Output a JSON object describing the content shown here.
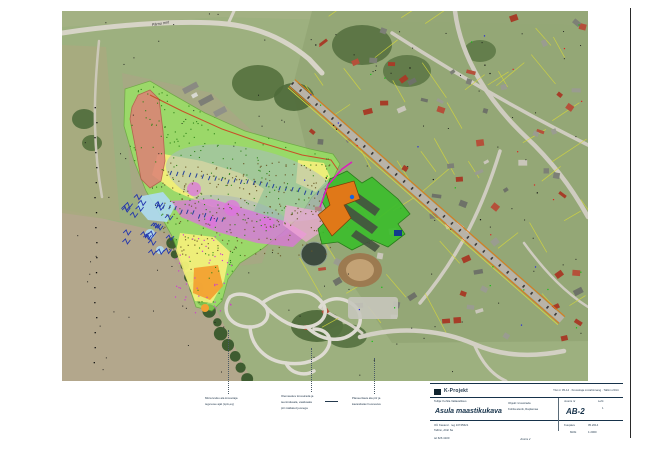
{
  "sheet": {
    "bg": "#ffffff",
    "edge_color": "#2a2a2a"
  },
  "map": {
    "road_label": "Pärnu mnt",
    "base": "#9db07f",
    "fields": [
      {
        "pts": [
          [
            0,
            198
          ],
          [
            112,
            224
          ],
          [
            150,
            290
          ],
          [
            190,
            370
          ],
          [
            0,
            370
          ]
        ],
        "fill": "#b3a78c",
        "op": 1
      },
      {
        "pts": [
          [
            0,
            34
          ],
          [
            44,
            36
          ],
          [
            58,
            210
          ],
          [
            0,
            202
          ]
        ],
        "fill": "#a8ab7f",
        "op": 0.9
      },
      {
        "pts": [
          [
            0,
            0
          ],
          [
            526,
            0
          ],
          [
            526,
            14
          ],
          [
            300,
            10
          ],
          [
            160,
            6
          ],
          [
            0,
            16
          ]
        ],
        "fill": "#a5b284",
        "op": 0.85
      },
      {
        "pts": [
          [
            230,
            78
          ],
          [
            250,
            0
          ],
          [
            526,
            0
          ],
          [
            526,
            330
          ],
          [
            330,
            332
          ],
          [
            268,
            240
          ]
        ],
        "fill": "#94a675",
        "op": 0.9
      },
      {
        "pts": [
          [
            60,
            62
          ],
          [
            150,
            82
          ],
          [
            232,
            160
          ],
          [
            200,
            252
          ],
          [
            120,
            262
          ],
          [
            70,
            182
          ]
        ],
        "fill": "#b0a287",
        "op": 0.5
      }
    ],
    "woods": [
      [
        196,
        72,
        26,
        18,
        "#55713e"
      ],
      [
        232,
        86,
        20,
        14,
        "#4e6a3a"
      ],
      [
        300,
        34,
        30,
        20,
        "#567141"
      ],
      [
        345,
        60,
        24,
        16,
        "#5d7847"
      ],
      [
        255,
        315,
        26,
        16,
        "#4c6838"
      ],
      [
        285,
        325,
        20,
        12,
        "#557140"
      ],
      [
        22,
        108,
        12,
        10,
        "#4f6b3c"
      ],
      [
        30,
        132,
        10,
        8,
        "#55713e"
      ],
      [
        418,
        40,
        16,
        11,
        "#5e7a48"
      ]
    ],
    "roads": [
      {
        "d": "M0,22 C60,13 125,9 165,13 C202,17 228,32 247,48 L260,62",
        "w": 5,
        "c": "#d7d4c7"
      },
      {
        "d": "M166,13 L172,0",
        "w": 3,
        "c": "#d7d4c7"
      },
      {
        "d": "M37,30 C32,80 30,130 40,186",
        "w": 2.5,
        "c": "#ccc8b8"
      },
      {
        "d": "M393,0 C399,48 428,92 464,126 C496,156 515,186 526,206",
        "w": 4.5,
        "c": "#cfccc0"
      },
      {
        "d": "M330,22 C392,62 462,102 526,134",
        "w": 3.5,
        "c": "#cfccc0"
      },
      {
        "d": "M438,140 C422,192 400,242 358,292",
        "w": 3.5,
        "c": "#cfccc0"
      },
      {
        "d": "M462,232 C484,262 504,282 526,296",
        "w": 2.5,
        "c": "#cfccc0"
      },
      {
        "d": "M298,326 C340,314 382,320 412,333 C442,346 472,346 502,340",
        "w": 4.5,
        "c": "#d3d0c4"
      },
      {
        "d": "M412,333 C420,352 430,364 444,370",
        "w": 3,
        "c": "#d3d0c4"
      },
      {
        "d": "M258,296 C270,306 286,310 300,322",
        "w": 3,
        "c": "#d3d0c4"
      }
    ],
    "railway": {
      "x1": 230,
      "y1": 72,
      "x2": 500,
      "y2": 309,
      "body": "#b9b3a8",
      "edge": "#e07818",
      "yellow": "#d8d840"
    },
    "track_paths": [
      "M168,286 C158,300 168,316 188,316 C206,316 211,300 200,292 C190,284 176,280 168,286 Z",
      "M200,292 C220,278 246,276 258,289 C269,300 262,314 245,316 C228,318 211,304 200,292 Z",
      "M245,316 C259,330 279,332 291,322 C303,312 299,297 287,291 C276,285 263,288 258,296",
      "M188,316 C189,335 204,350 224,352 C247,355 263,346 267,334 C270,324 262,318 252,318",
      "M224,352 C228,362 242,366 252,360"
    ],
    "track_color": "#dedbd2",
    "pond": [
      252,
      243,
      13,
      12,
      "#3c4a3e",
      "#8fa08f"
    ],
    "dirt_oval": {
      "outer": [
        298,
        259,
        22,
        17,
        "#9c7a50"
      ],
      "inner": [
        298,
        259,
        14,
        11,
        "#c3a275"
      ]
    },
    "parking": [
      286,
      286,
      50,
      22,
      "#c6c6bc"
    ],
    "treerow": {
      "x1": 108,
      "y1": 232,
      "x2": 186,
      "y2": 368,
      "n": 13,
      "c": "#3e5c30"
    },
    "buildings_mid": [
      [
        120,
        78,
        16,
        6,
        -28,
        "#8a8a82"
      ],
      [
        136,
        90,
        15,
        6,
        -28,
        "#7d7e76"
      ],
      [
        151,
        101,
        13,
        6,
        -28,
        "#8f9088"
      ],
      [
        129,
        84,
        6,
        4,
        -28,
        "#d8d8d0"
      ]
    ],
    "zones": {
      "green": {
        "pts": [
          [
            63,
            78
          ],
          [
            88,
            70
          ],
          [
            108,
            82
          ],
          [
            143,
            102
          ],
          [
            183,
            120
          ],
          [
            218,
            130
          ],
          [
            248,
            138
          ],
          [
            271,
            143
          ],
          [
            278,
            153
          ],
          [
            271,
            168
          ],
          [
            250,
            186
          ],
          [
            238,
            205
          ],
          [
            220,
            222
          ],
          [
            200,
            238
          ],
          [
            178,
            252
          ],
          [
            166,
            268
          ],
          [
            160,
            290
          ],
          [
            150,
            300
          ],
          [
            134,
            296
          ],
          [
            128,
            278
          ],
          [
            120,
            252
          ],
          [
            110,
            225
          ],
          [
            96,
            200
          ],
          [
            84,
            180
          ],
          [
            72,
            150
          ],
          [
            62,
            115
          ]
        ],
        "fill": "#97ef5e",
        "op": 0.68
      },
      "yellow": [
        [
          [
            96,
            142
          ],
          [
            140,
            150
          ],
          [
            178,
            162
          ],
          [
            202,
            178
          ],
          [
            192,
            200
          ],
          [
            150,
            196
          ],
          [
            112,
            180
          ],
          [
            90,
            164
          ]
        ],
        [
          [
            118,
            222
          ],
          [
            152,
            226
          ],
          [
            168,
            241
          ],
          [
            162,
            270
          ],
          [
            150,
            292
          ],
          [
            133,
            290
          ],
          [
            122,
            262
          ],
          [
            114,
            240
          ]
        ],
        [
          [
            236,
            149
          ],
          [
            262,
            152
          ],
          [
            268,
            166
          ],
          [
            254,
            181
          ],
          [
            234,
            172
          ]
        ]
      ],
      "yellow_fill": "#fdf27c",
      "yellow_op": 0.85,
      "gray_ellipses": [
        [
          190,
          172,
          88,
          34,
          13,
          "#a9b8c9",
          0.5
        ],
        [
          176,
          206,
          54,
          19,
          13,
          "#9fb0c4",
          0.4
        ]
      ],
      "magenta_band": [
        [
          108,
          190
        ],
        [
          150,
          188
        ],
        [
          190,
          200
        ],
        [
          225,
          211
        ],
        [
          245,
          223
        ],
        [
          231,
          236
        ],
        [
          195,
          232
        ],
        [
          152,
          220
        ],
        [
          119,
          206
        ]
      ],
      "magenta_blobs": [
        [
          132,
          178,
          7
        ],
        [
          170,
          197,
          8
        ],
        [
          205,
          213,
          7
        ],
        [
          149,
          211,
          6
        ]
      ],
      "magenta_fill": "#df72df",
      "magenta_op": 0.72,
      "pink": {
        "pts": [
          [
            224,
            194
          ],
          [
            256,
            200
          ],
          [
            263,
            218
          ],
          [
            244,
            231
          ],
          [
            221,
            214
          ]
        ],
        "fill": "#f2a8d8",
        "op": 0.7
      },
      "red": {
        "pts": [
          [
            70,
            96
          ],
          [
            76,
            84
          ],
          [
            88,
            79
          ],
          [
            97,
            88
          ],
          [
            101,
            120
          ],
          [
            103,
            150
          ],
          [
            99,
            170
          ],
          [
            88,
            177
          ],
          [
            79,
            168
          ],
          [
            73,
            134
          ],
          [
            68,
            108
          ]
        ],
        "fill": "#dd8077",
        "op": 0.85,
        "stroke": "#b5524a"
      },
      "blue_patch": {
        "pts": [
          [
            80,
            185
          ],
          [
            101,
            181
          ],
          [
            113,
            195
          ],
          [
            105,
            211
          ],
          [
            86,
            209
          ],
          [
            75,
            196
          ]
        ],
        "fill": "#aedcf2",
        "op": 0.9
      },
      "blue_circles": [
        [
          88,
          223,
          5
        ],
        [
          98,
          239,
          4
        ]
      ],
      "orange_patch": {
        "pts": [
          [
            132,
            257
          ],
          [
            156,
            254
          ],
          [
            161,
            275
          ],
          [
            148,
            289
          ],
          [
            131,
            282
          ]
        ],
        "fill": "#f2a132",
        "op": 0.95
      },
      "orange_circle": [
        143,
        297,
        4
      ],
      "contour": [
        [
          88,
          84
        ],
        [
          120,
          100
        ],
        [
          160,
          118
        ],
        [
          200,
          132
        ],
        [
          240,
          144
        ],
        [
          269,
          149
        ],
        [
          276,
          159
        ]
      ],
      "contour_color": "#c85028",
      "tick_rows": [
        {
          "x1": 108,
          "y1": 163,
          "x2": 268,
          "y2": 186,
          "n": 26
        },
        {
          "x1": 95,
          "y1": 196,
          "x2": 160,
          "y2": 212,
          "n": 12
        }
      ],
      "tick_color": "#23409a"
    },
    "site": {
      "green": {
        "pts": [
          [
            268,
            168
          ],
          [
            285,
            160
          ],
          [
            300,
            172
          ],
          [
            310,
            166
          ],
          [
            336,
            188
          ],
          [
            348,
            203
          ],
          [
            336,
            213
          ],
          [
            343,
            223
          ],
          [
            326,
            236
          ],
          [
            310,
            229
          ],
          [
            290,
            239
          ],
          [
            276,
            231
          ],
          [
            260,
            233
          ],
          [
            256,
            218
          ],
          [
            268,
            206
          ],
          [
            260,
            190
          ]
        ],
        "fill": "#3dbd2d",
        "op": 0.92
      },
      "strips": [
        [
          [
            293,
            180
          ],
          [
            318,
            198
          ],
          [
            313,
            205
          ],
          [
            288,
            187
          ]
        ],
        [
          [
            284,
            193
          ],
          [
            316,
            216
          ],
          [
            310,
            223
          ],
          [
            278,
            200
          ]
        ],
        [
          [
            294,
            219
          ],
          [
            318,
            235
          ],
          [
            313,
            241
          ],
          [
            289,
            225
          ]
        ]
      ],
      "strip_fill": "#44523f",
      "orange_building": {
        "pts": [
          [
            263,
            178
          ],
          [
            292,
            170
          ],
          [
            298,
            188
          ],
          [
            282,
            194
          ],
          [
            289,
            207
          ],
          [
            270,
            225
          ],
          [
            256,
            204
          ],
          [
            268,
            194
          ]
        ],
        "fill": "#e07818",
        "stroke": "#7a3c08"
      },
      "magenta_line": [
        [
          258,
          196
        ],
        [
          266,
          174
        ],
        [
          280,
          158
        ],
        [
          290,
          151
        ]
      ],
      "magenta_color": "#e018c0",
      "blue_marker": [
        290,
        186,
        2.2,
        "#1565e0"
      ],
      "navy_square": [
        332,
        219,
        8,
        6,
        "#123a8c"
      ]
    },
    "procedural": {
      "seed": 42,
      "parcels": {
        "count": 46,
        "color": "#d6d83a"
      },
      "houses": {
        "count": 78,
        "colors": [
          "#6e7268",
          "#7d8076",
          "#9a9c90",
          "#a63d28",
          "#b5503a",
          "#c9c6ba"
        ]
      },
      "green_dots": {
        "count": 430,
        "color": "#2e8418"
      },
      "brown_dots": {
        "count": 240,
        "color": "#6a5a28"
      },
      "magenta_dots": {
        "count": 45,
        "color": "#cc3fcc"
      },
      "black_dots": {
        "count": 110,
        "color": "#141414"
      },
      "confetti": {
        "count": 50,
        "colors": [
          "#10c010",
          "#e02020",
          "#2020e0",
          "#111111"
        ]
      },
      "scribbles": {
        "count": 24,
        "color": "#2336ad"
      }
    }
  },
  "annotations": {
    "blocks": [
      {
        "lines": [
          "Müra leviku ala krossiraja",
          "tegevuse ajal (LpA,eq)"
        ]
      },
      {
        "lines": [
          "Olemasolev krossirada ja",
          "teenindusala, vaatlusala",
          "piir näidatud joonega"
        ]
      },
      {
        "lines": [
          "Planeeritava ala piir ja",
          "kavandatav hoonestus"
        ]
      }
    ]
  },
  "title_block": {
    "company": "K-Projekt",
    "row1_right": "Töö nr 05-14  ·  Krossiraja mürahinnang  ·  Tallinn 2014",
    "client_caption": "Tellija: Kohila Vallavalitsus",
    "title": "Asula maastikukava",
    "mid_line1": "Objekt: krossirada",
    "mid_line2": "Kohila alevik, Raplamaa",
    "sheet_caption": "Joonis nr",
    "sheet_no": "AB-2",
    "leht_caption": "Leht",
    "leht_no": "1",
    "row3_line1": "OÜ Kavand · reg 10745621",
    "row3_line2": "Tallinn, Ahtri 6a",
    "row3_line3": "tel 626 4100",
    "date_caption": "Kuupäev",
    "date_value": "05.2014",
    "scale_caption": "Mõõt",
    "scale_value": "1:2000",
    "bottom_center": "Joonis 2"
  }
}
